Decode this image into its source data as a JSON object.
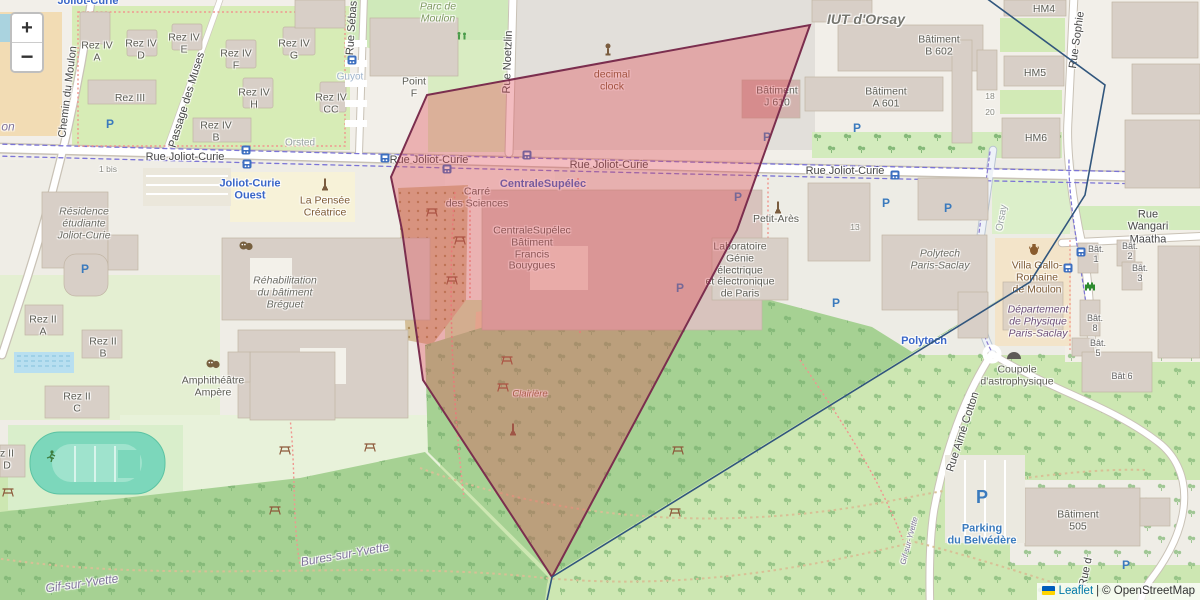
{
  "zoom_control": {
    "zoom_in": "+",
    "zoom_out": "−"
  },
  "attribution": {
    "leaflet_link": "Leaflet",
    "separator": "|",
    "osm_text": "© OpenStreetMap"
  },
  "overlays": {
    "red_polygon": {
      "stroke": "#7b2e4e",
      "fill": "rgba(222,73,83,0.37)",
      "points": [
        [
          427,
          95
        ],
        [
          810,
          25
        ],
        [
          737,
          230
        ],
        [
          552,
          577
        ],
        [
          423,
          380
        ],
        [
          402,
          230
        ],
        [
          391,
          177
        ]
      ]
    },
    "blue_polyline": {
      "stroke": "#31567d",
      "points": [
        [
          982,
          -5
        ],
        [
          1105,
          85
        ],
        [
          1085,
          195
        ],
        [
          1030,
          282
        ],
        [
          552,
          577
        ],
        [
          546,
          605
        ]
      ]
    }
  },
  "map": {
    "labels": [
      {
        "t": "Rue Joliot-Curie",
        "x": 185,
        "y": 157,
        "c": "street"
      },
      {
        "t": "Rue Joliot-Curie",
        "x": 429,
        "y": 160,
        "c": "street"
      },
      {
        "t": "Rue Joliot-Curie",
        "x": 609,
        "y": 165,
        "c": "street"
      },
      {
        "t": "Rue Joliot-Curie",
        "x": 845,
        "y": 171,
        "c": "street"
      },
      {
        "t": "Chemin du Moulon",
        "x": 68,
        "y": 92,
        "c": "street",
        "r": -83
      },
      {
        "t": "Passage des Muses",
        "x": 187,
        "y": 100,
        "c": "street",
        "r": -73
      },
      {
        "t": "Rue Sébas",
        "x": 352,
        "y": 28,
        "c": "street",
        "r": -86
      },
      {
        "t": "Rue Noetzlin",
        "x": 508,
        "y": 62,
        "c": "street",
        "r": -88
      },
      {
        "t": "Rue Sophie",
        "x": 1077,
        "y": 40,
        "c": "street",
        "r": -82
      },
      {
        "t": "Rue Wangari Maatha",
        "x": 1148,
        "y": 227,
        "c": "street"
      },
      {
        "t": "Rue Aimé Cotton",
        "x": 963,
        "y": 432,
        "c": "street",
        "r": -72
      },
      {
        "t": "Orsay",
        "x": 1002,
        "y": 218,
        "c": "faint",
        "r": -80
      },
      {
        "t": "Rue d",
        "x": 1086,
        "y": 572,
        "c": "street",
        "r": -78
      },
      {
        "t": "Orsted",
        "x": 300,
        "y": 143,
        "c": "faint"
      },
      {
        "t": "Guyot",
        "x": 350,
        "y": 77,
        "c": "faint-blue"
      },
      {
        "t": "1 bis",
        "x": 108,
        "y": 170,
        "c": "tiny"
      },
      {
        "t": "18",
        "x": 990,
        "y": 97,
        "c": "tiny"
      },
      {
        "t": "20",
        "x": 990,
        "y": 113,
        "c": "tiny"
      },
      {
        "t": "13",
        "x": 855,
        "y": 228,
        "c": "tiny"
      },
      {
        "t": "Joliot-Curie",
        "x": 88,
        "y": 1,
        "c": "transit"
      },
      {
        "l": [
          "Joliot-Curie",
          "Ouest"
        ],
        "x": 250,
        "y": 190,
        "c": "transit"
      },
      {
        "t": "CentraleSupélec",
        "x": 543,
        "y": 184,
        "c": "transit"
      },
      {
        "t": "Polytech",
        "x": 924,
        "y": 341,
        "c": "transit"
      },
      {
        "l": [
          "Parking",
          "du Belvédère"
        ],
        "x": 982,
        "y": 535,
        "c": "parking-label"
      },
      {
        "t": "on",
        "x": 8,
        "y": 127,
        "c": "place"
      },
      {
        "t": "Gif-sur-Yvette",
        "x": 82,
        "y": 584,
        "c": "place",
        "r": -8
      },
      {
        "t": "Bures-sur-Yvette",
        "x": 345,
        "y": 555,
        "c": "place",
        "r": -10
      },
      {
        "t": "Gif-sur-Yvette",
        "x": 910,
        "y": 541,
        "c": "place-sm",
        "r": -75
      },
      {
        "l": [
          "Rez IV",
          "A"
        ],
        "x": 97,
        "y": 52
      },
      {
        "l": [
          "Rez IV",
          "D"
        ],
        "x": 141,
        "y": 50
      },
      {
        "l": [
          "Rez IV",
          "E"
        ],
        "x": 184,
        "y": 44
      },
      {
        "l": [
          "Rez IV",
          "F"
        ],
        "x": 236,
        "y": 60
      },
      {
        "l": [
          "Rez IV",
          "G"
        ],
        "x": 294,
        "y": 50
      },
      {
        "l": [
          "Rez IV",
          "H"
        ],
        "x": 254,
        "y": 99
      },
      {
        "l": [
          "Rez IV",
          "CC"
        ],
        "x": 331,
        "y": 104
      },
      {
        "l": [
          "Rez IV",
          "B"
        ],
        "x": 216,
        "y": 132
      },
      {
        "t": "Rez III",
        "x": 130,
        "y": 99
      },
      {
        "l": [
          "Point",
          "F"
        ],
        "x": 414,
        "y": 88
      },
      {
        "l": [
          "Parc de",
          "Moulon"
        ],
        "x": 438,
        "y": 13,
        "c": "park"
      },
      {
        "l": [
          "decimal",
          "clock"
        ],
        "x": 612,
        "y": 81,
        "c": "brown"
      },
      {
        "t": "IUT d'Orsay",
        "x": 866,
        "y": 20,
        "c": "area-big"
      },
      {
        "l": [
          "Bâtiment",
          "B 602"
        ],
        "x": 939,
        "y": 46
      },
      {
        "l": [
          "Bâtiment",
          "A 601"
        ],
        "x": 886,
        "y": 98
      },
      {
        "t": "HM4",
        "x": 1044,
        "y": 10
      },
      {
        "t": "HM5",
        "x": 1035,
        "y": 74
      },
      {
        "t": "HM6",
        "x": 1036,
        "y": 139
      },
      {
        "l": [
          "Bâtiment",
          "J 610"
        ],
        "x": 777,
        "y": 97
      },
      {
        "l": [
          "Carré",
          "des Sciences"
        ],
        "x": 477,
        "y": 198
      },
      {
        "l": [
          "CentraleSupélec",
          "Bâtiment",
          "Francis",
          "Bouygues"
        ],
        "x": 532,
        "y": 249
      },
      {
        "l": [
          "Laboratoire",
          "Génie",
          "électrique",
          "et électronique",
          "de Paris"
        ],
        "x": 740,
        "y": 271
      },
      {
        "t": "Petit-Arès",
        "x": 776,
        "y": 220
      },
      {
        "l": [
          "La Pensée",
          "Créatrice"
        ],
        "x": 325,
        "y": 207,
        "c": "brown"
      },
      {
        "l": [
          "Résidence",
          "étudiante",
          "Joliot-Curie"
        ],
        "x": 84,
        "y": 224,
        "c": "poi-italic"
      },
      {
        "l": [
          "Réhabilitation",
          "du bâtiment",
          "Bréguet"
        ],
        "x": 285,
        "y": 293,
        "c": "poi-italic"
      },
      {
        "l": [
          "Rez II",
          "A"
        ],
        "x": 43,
        "y": 326
      },
      {
        "l": [
          "Rez II",
          "B"
        ],
        "x": 103,
        "y": 348
      },
      {
        "l": [
          "Rez II",
          "C"
        ],
        "x": 77,
        "y": 403
      },
      {
        "l": [
          "z II",
          "D"
        ],
        "x": 7,
        "y": 460
      },
      {
        "l": [
          "Amphithéâtre",
          "Ampère"
        ],
        "x": 213,
        "y": 387
      },
      {
        "l": [
          "Polytech",
          "Paris-Saclay"
        ],
        "x": 940,
        "y": 260,
        "c": "poi-italic"
      },
      {
        "l": [
          "Villa Gallo-",
          "Romaine",
          "de Moulon"
        ],
        "x": 1037,
        "y": 278,
        "c": "brown"
      },
      {
        "l": [
          "Département",
          "de Physique",
          "Paris-Saclay"
        ],
        "x": 1038,
        "y": 322,
        "c": "mauve"
      },
      {
        "l": [
          "Coupole",
          "d'astrophysique"
        ],
        "x": 1017,
        "y": 376
      },
      {
        "l": [
          "Bât.",
          "1"
        ],
        "x": 1096,
        "y": 254,
        "c": "tiny2"
      },
      {
        "l": [
          "Bât.",
          "2"
        ],
        "x": 1130,
        "y": 251,
        "c": "tiny2"
      },
      {
        "l": [
          "Bât.",
          "3"
        ],
        "x": 1140,
        "y": 273,
        "c": "tiny2"
      },
      {
        "l": [
          "Bât.",
          "8"
        ],
        "x": 1095,
        "y": 323,
        "c": "tiny2"
      },
      {
        "l": [
          "Bât.",
          "5"
        ],
        "x": 1098,
        "y": 348,
        "c": "tiny2"
      },
      {
        "t": "Bât 6",
        "x": 1122,
        "y": 376,
        "c": "tiny2"
      },
      {
        "l": [
          "Bâtiment",
          "505"
        ],
        "x": 1078,
        "y": 521
      },
      {
        "t": "Clairière",
        "x": 530,
        "y": 395,
        "c": "brown-it"
      }
    ],
    "icons": [
      {
        "type": "parking",
        "x": 110,
        "y": 124
      },
      {
        "type": "parking",
        "x": 85,
        "y": 269
      },
      {
        "type": "parking",
        "x": 767,
        "y": 137
      },
      {
        "type": "parking",
        "x": 857,
        "y": 128
      },
      {
        "type": "parking",
        "x": 886,
        "y": 203
      },
      {
        "type": "parking",
        "x": 680,
        "y": 288
      },
      {
        "type": "parking",
        "x": 738,
        "y": 197
      },
      {
        "type": "parking",
        "x": 836,
        "y": 303
      },
      {
        "type": "parking",
        "x": 948,
        "y": 208
      },
      {
        "type": "parking",
        "x": 1126,
        "y": 565
      },
      {
        "type": "parking-big",
        "x": 982,
        "y": 497
      },
      {
        "type": "bus",
        "x": 246,
        "y": 150
      },
      {
        "type": "bus",
        "x": 247,
        "y": 164
      },
      {
        "type": "bus",
        "x": 385,
        "y": 158
      },
      {
        "type": "bus",
        "x": 447,
        "y": 169
      },
      {
        "type": "bus",
        "x": 527,
        "y": 155
      },
      {
        "type": "bus",
        "x": 895,
        "y": 175
      },
      {
        "type": "bus",
        "x": 352,
        "y": 60
      },
      {
        "type": "bus",
        "x": 1081,
        "y": 252
      },
      {
        "type": "bus",
        "x": 1068,
        "y": 268
      },
      {
        "type": "monument",
        "x": 325,
        "y": 185
      },
      {
        "type": "monument",
        "x": 778,
        "y": 208
      },
      {
        "type": "monument",
        "x": 513,
        "y": 430
      },
      {
        "type": "clock",
        "x": 608,
        "y": 50
      },
      {
        "type": "masks",
        "x": 246,
        "y": 246
      },
      {
        "type": "masks",
        "x": 213,
        "y": 364
      },
      {
        "type": "picnic",
        "x": 432,
        "y": 212
      },
      {
        "type": "picnic",
        "x": 460,
        "y": 240
      },
      {
        "type": "picnic",
        "x": 452,
        "y": 280
      },
      {
        "type": "picnic",
        "x": 507,
        "y": 360
      },
      {
        "type": "picnic",
        "x": 503,
        "y": 387
      },
      {
        "type": "picnic",
        "x": 285,
        "y": 450
      },
      {
        "type": "picnic",
        "x": 370,
        "y": 447
      },
      {
        "type": "picnic",
        "x": 275,
        "y": 510
      },
      {
        "type": "picnic",
        "x": 678,
        "y": 450
      },
      {
        "type": "picnic",
        "x": 675,
        "y": 512
      },
      {
        "type": "picnic",
        "x": 8,
        "y": 492
      },
      {
        "type": "runner",
        "x": 51,
        "y": 456
      },
      {
        "type": "invader",
        "x": 1090,
        "y": 287
      },
      {
        "type": "amphora",
        "x": 1034,
        "y": 250
      },
      {
        "type": "dome",
        "x": 1014,
        "y": 355
      },
      {
        "type": "playground",
        "x": 462,
        "y": 36
      }
    ]
  }
}
